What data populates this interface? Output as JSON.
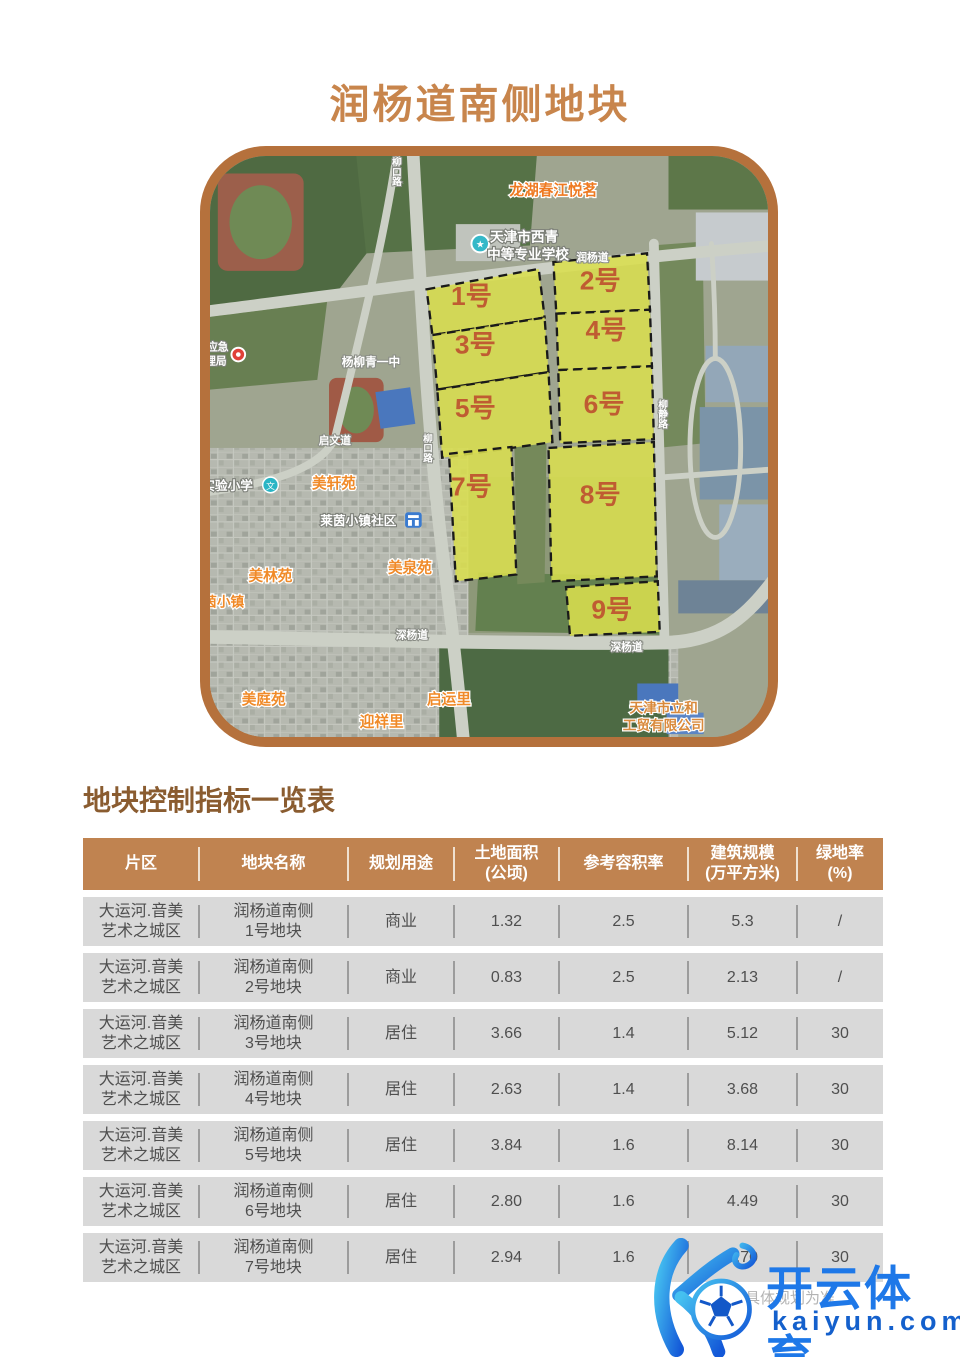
{
  "page": {
    "title": "润杨道南侧地块"
  },
  "colors": {
    "accent_brown": "#b5713c",
    "title_brown": "#c8854c",
    "table_header_bg": "#c08350",
    "table_row_bg": "#d9d9d9",
    "plot_fill": "#dade4e",
    "plot_number_text": "#bf5c32",
    "watermark_blue": "#1e78e8"
  },
  "map": {
    "plots": [
      {
        "label": "1号"
      },
      {
        "label": "2号"
      },
      {
        "label": "3号"
      },
      {
        "label": "4号"
      },
      {
        "label": "5号"
      },
      {
        "label": "6号"
      },
      {
        "label": "7号"
      },
      {
        "label": "8号"
      },
      {
        "label": "9号"
      }
    ],
    "labels": {
      "longhu": "龙湖春江悦茗",
      "school_line1": "天津市西青",
      "school_line2": "中等专业学校",
      "runyang_road": "润杨道",
      "yangliuqing": "杨柳青一中",
      "qiwen_road": "启文道",
      "liukou_road_a": "柳口路",
      "liukou_road_b": "柳口路",
      "liujing_road": "柳静路",
      "primary_school": "实验小学",
      "meixuan": "美轩苑",
      "laiyin": "莱茵小镇社区",
      "meiquan": "美泉苑",
      "meilin": "美林苑",
      "yinxiaozhen": "茵小镇",
      "south_road_a": "深杨道",
      "south_road_b": "深杨道",
      "meiting": "美庭苑",
      "qiyun": "启运里",
      "yingxiang": "迎祥里",
      "company_line1": "天津市立和",
      "company_line2": "工贸有限公司",
      "emergency_line1": "应急",
      "emergency_line2": "理局"
    }
  },
  "table": {
    "section_title": "地块控制指标一览表",
    "headers": [
      "片区",
      "地块名称",
      "规划用途",
      "土地面积\n(公顷)",
      "参考容积率",
      "建筑规模\n(万平方米)",
      "绿地率\n(%)"
    ],
    "rows": [
      {
        "district": "大运河.音美\n艺术之城区",
        "name": "润杨道南侧\n1号地块",
        "use": "商业",
        "area": "1.32",
        "far": "2.5",
        "scale": "5.3",
        "green": "/"
      },
      {
        "district": "大运河.音美\n艺术之城区",
        "name": "润杨道南侧\n2号地块",
        "use": "商业",
        "area": "0.83",
        "far": "2.5",
        "scale": "2.13",
        "green": "/"
      },
      {
        "district": "大运河.音美\n艺术之城区",
        "name": "润杨道南侧\n3号地块",
        "use": "居住",
        "area": "3.66",
        "far": "1.4",
        "scale": "5.12",
        "green": "30"
      },
      {
        "district": "大运河.音美\n艺术之城区",
        "name": "润杨道南侧\n4号地块",
        "use": "居住",
        "area": "2.63",
        "far": "1.4",
        "scale": "3.68",
        "green": "30"
      },
      {
        "district": "大运河.音美\n艺术之城区",
        "name": "润杨道南侧\n5号地块",
        "use": "居住",
        "area": "3.84",
        "far": "1.6",
        "scale": "8.14",
        "green": "30"
      },
      {
        "district": "大运河.音美\n艺术之城区",
        "name": "润杨道南侧\n6号地块",
        "use": "居住",
        "area": "2.80",
        "far": "1.6",
        "scale": "4.49",
        "green": "30"
      },
      {
        "district": "大运河.音美\n艺术之城区",
        "name": "润杨道南侧\n7号地块",
        "use": "居住",
        "area": "2.94",
        "far": "1.6",
        "scale": "4.70",
        "green": "30"
      }
    ]
  },
  "footnote": "指标以具体规划为准",
  "watermark": {
    "brand": "开云体育",
    "domain": "kaiyun.com"
  }
}
